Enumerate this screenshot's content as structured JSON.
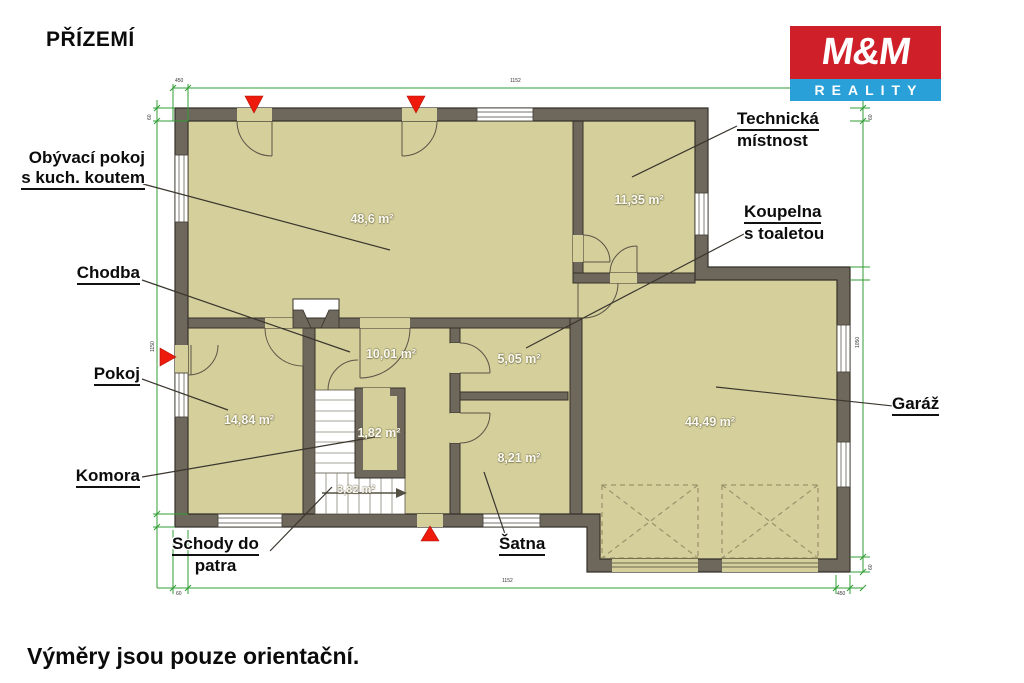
{
  "title": "PŘÍZEMÍ",
  "footer": "Výměry jsou pouze orientační.",
  "logo": {
    "top": "M&M",
    "bottom": "REALITY",
    "red": "#cf202a",
    "blue": "#2aa0d8"
  },
  "rooms": {
    "living": {
      "label1": "Obývací pokoj",
      "label2": "s kuch. koutem",
      "area": "48,6 m²"
    },
    "tech": {
      "label1": "Technická",
      "label2": "místnost",
      "area": "11,35 m²"
    },
    "hallway": {
      "label": "Chodba",
      "area": "10,01 m²"
    },
    "bathroom": {
      "label1": "Koupelna",
      "label2": "s toaletou",
      "area": "5,05 m²"
    },
    "room": {
      "label": "Pokoj",
      "area": "14,84 m²"
    },
    "pantry": {
      "label": "Komora",
      "area": "1,82 m²"
    },
    "stairs": {
      "label1": "Schody do",
      "label2": "patra",
      "area": "3,82 m²"
    },
    "closet": {
      "label": "Šatna",
      "area": "8,21 m²"
    },
    "garage": {
      "label": "Garáž",
      "area": "44,49 m²"
    }
  },
  "dimensions": {
    "top_small": "450",
    "top_main": "1152",
    "left_small": "60",
    "left_main": "1150",
    "right_small": "60",
    "right_main": "1050",
    "right_bottom": "60",
    "bottom_small": "60",
    "bottom_main": "1152",
    "bottom_right": "450"
  },
  "colors": {
    "floor": "#d5d09b",
    "wall": "#6e675c",
    "wall_stroke": "#35312a",
    "dimension_green": "#2f9e33",
    "arrow_red": "#ee1b0c",
    "logo_red": "#cf202a",
    "logo_blue": "#2aa0d8"
  }
}
